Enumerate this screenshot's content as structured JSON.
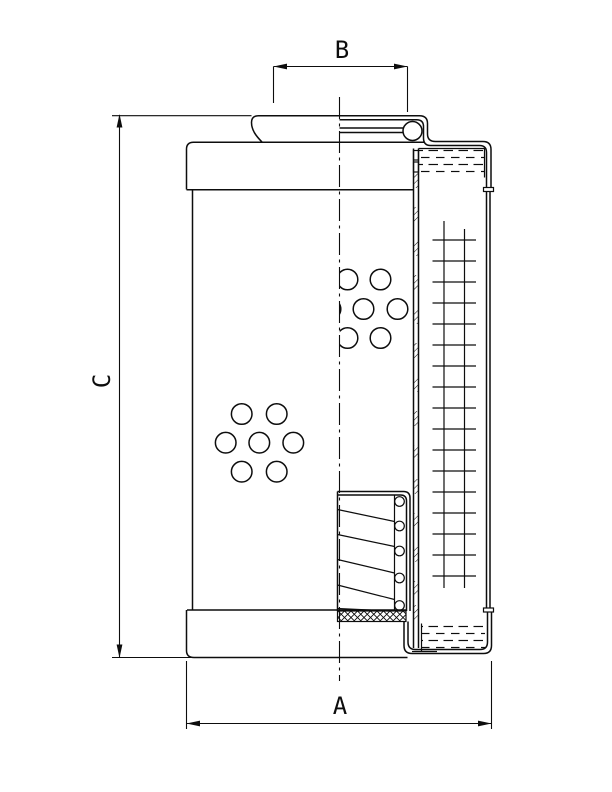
{
  "drawing": {
    "type": "technical-half-section-drawing",
    "subject": "filter-element",
    "dimension_labels": {
      "a": "A",
      "b": "B",
      "c": "C"
    },
    "style": {
      "background": "#ffffff",
      "line_color": "#0d0d0d"
    }
  }
}
